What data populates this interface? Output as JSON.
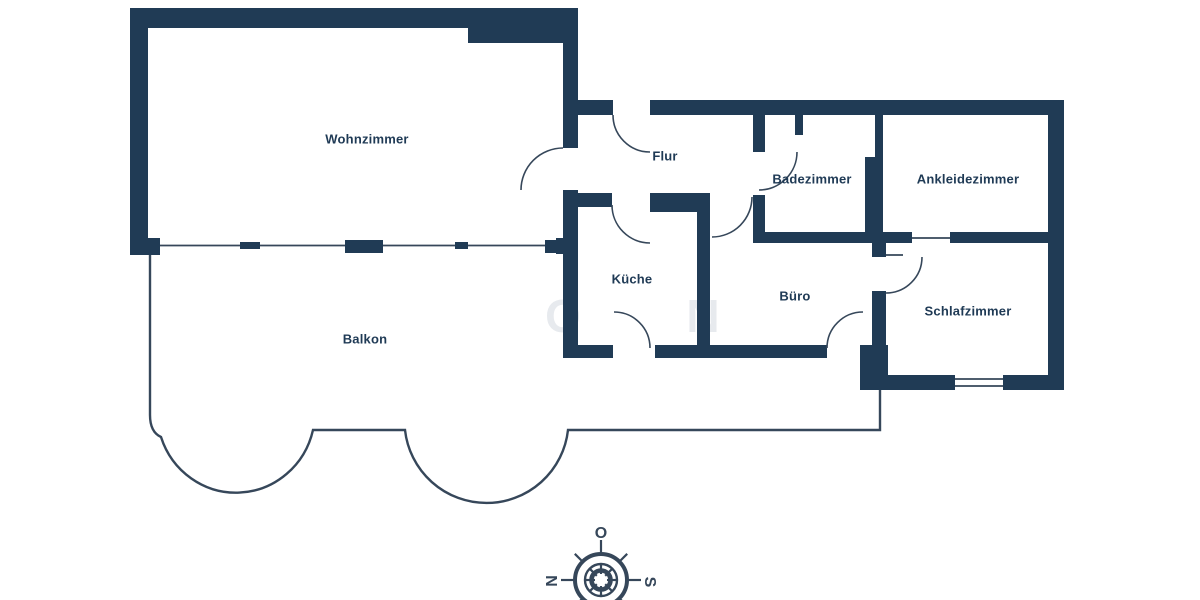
{
  "rooms": [
    {
      "label": "Wohnzimmer"
    },
    {
      "label": "Flur"
    },
    {
      "label": "Badezimmer"
    },
    {
      "label": "Ankleidezimmer"
    },
    {
      "label": "Küche"
    },
    {
      "label": "Büro"
    },
    {
      "label": "Schlafzimmer"
    },
    {
      "label": "Balkon"
    }
  ],
  "compass": {
    "top_label": "O",
    "left_label": "N",
    "right_label": "S"
  },
  "watermark": {
    "letter_1": "O",
    "letter_2": "N"
  },
  "colors": {
    "wall": "#203b55",
    "line": "#36475a",
    "label": "#1f3a55",
    "background": "#ffffff",
    "watermark": "#e7eaee"
  }
}
